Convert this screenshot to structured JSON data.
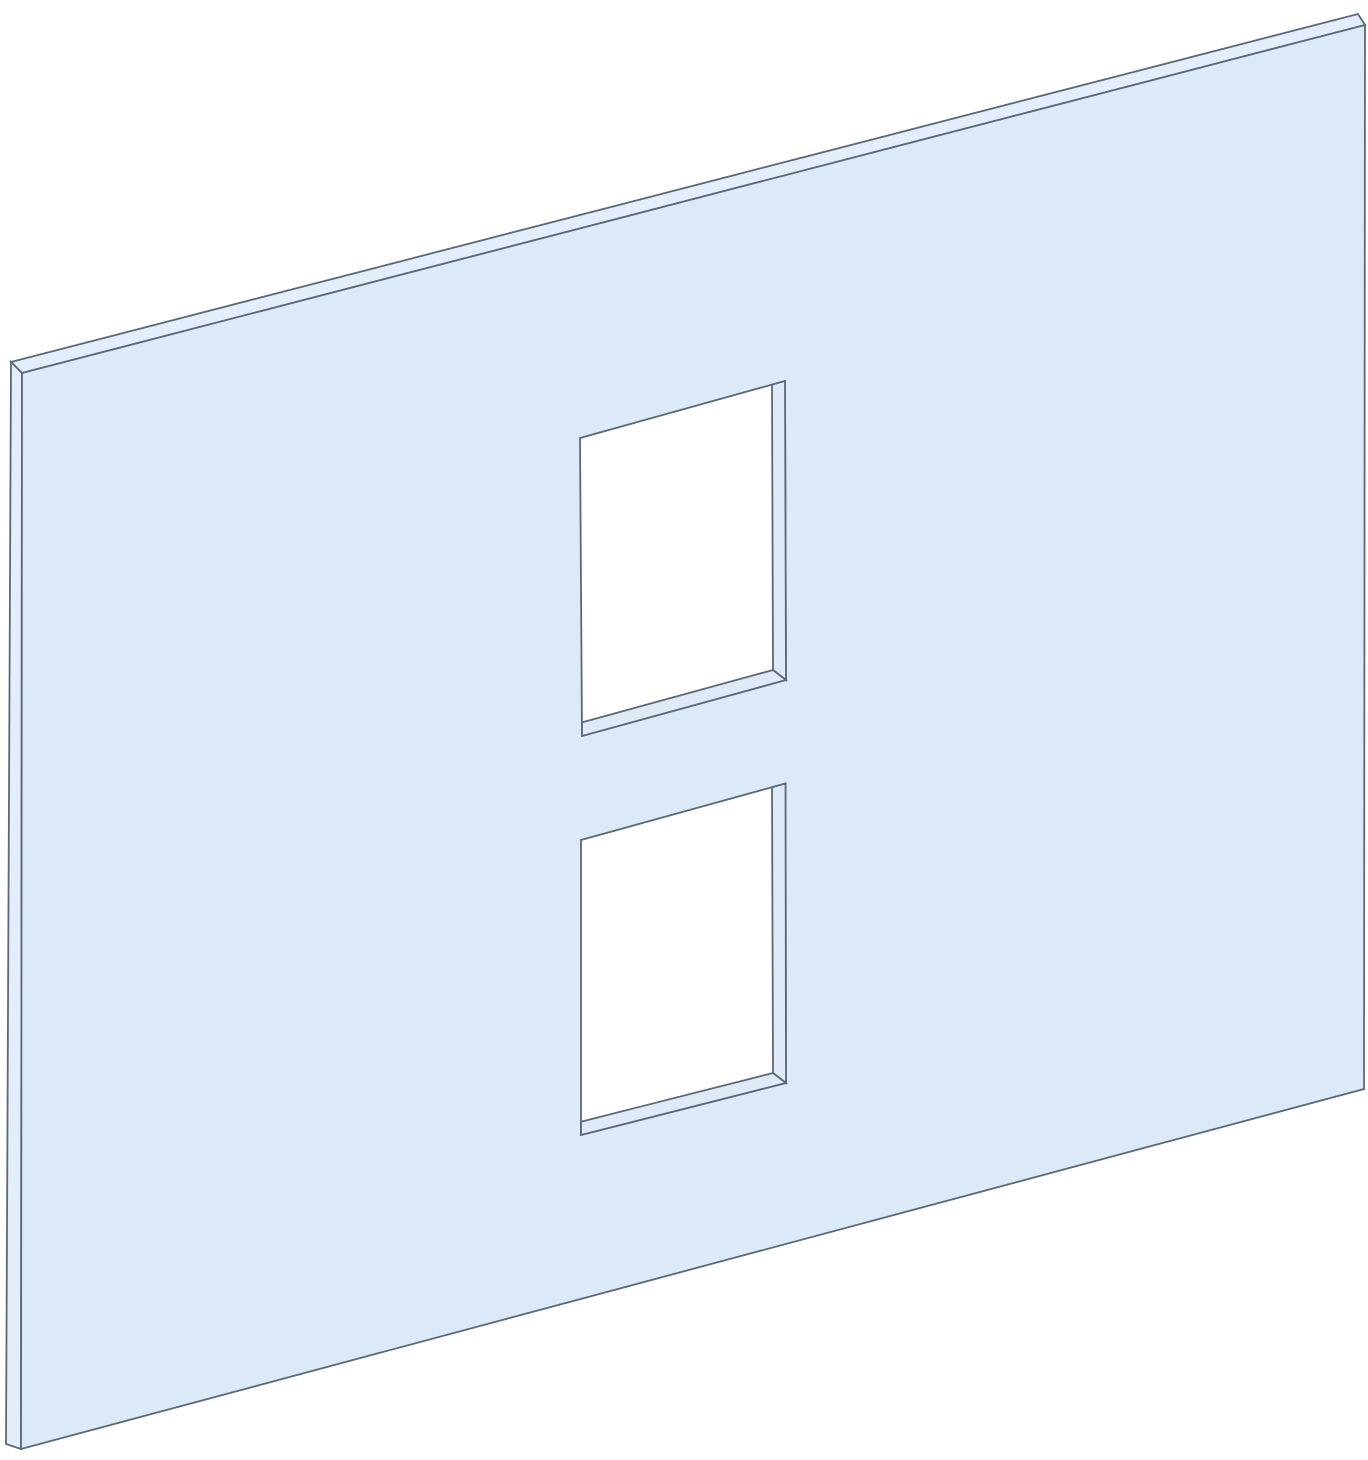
{
  "canvas": {
    "width": 1368,
    "height": 1460,
    "background": "#ffffff"
  },
  "palette": {
    "panel_face": "#dce9f7",
    "panel_edge_face": "#e4eefa",
    "inner_wall": "#dfeaf6",
    "hole": "#ffffff",
    "line": "#5a6978",
    "line_width": 1.8
  },
  "shapes": [
    {
      "name": "panel-top-edge-face",
      "type": "polygon",
      "fill": "panel_edge_face",
      "points": [
        [
          22,
          373
        ],
        [
          11,
          362
        ],
        [
          1358,
          14
        ],
        [
          1365,
          25
        ]
      ]
    },
    {
      "name": "panel-left-edge-face",
      "type": "polygon",
      "fill": "panel_edge_face",
      "points": [
        [
          11,
          362
        ],
        [
          22,
          373
        ],
        [
          21,
          1449
        ],
        [
          6,
          1444
        ]
      ]
    },
    {
      "name": "panel-front-face",
      "type": "path",
      "fill": "panel_face",
      "fillRule": "evenodd",
      "d": "M22,373 L1365,25 L1364,1089 L21,1449 Z M580,438 L785,381 L786,680 L582,736 Z M581,840 L785.5,783.5 L786,1083 L581,1135 Z"
    },
    {
      "name": "upper-cutout-right-inner-wall",
      "type": "polygon",
      "fill": "inner_wall",
      "points": [
        [
          772,
          384.6
        ],
        [
          785,
          381
        ],
        [
          786,
          680
        ],
        [
          773,
          670
        ]
      ]
    },
    {
      "name": "upper-cutout-bottom-inner-wall",
      "type": "polygon",
      "fill": "inner_wall",
      "points": [
        [
          582,
          722.4
        ],
        [
          773,
          670
        ],
        [
          786,
          680
        ],
        [
          582,
          736
        ]
      ]
    },
    {
      "name": "lower-cutout-right-inner-wall",
      "type": "polygon",
      "fill": "inner_wall",
      "points": [
        [
          772,
          787.3
        ],
        [
          785.5,
          783.5
        ],
        [
          786,
          1083
        ],
        [
          773,
          1073
        ]
      ]
    },
    {
      "name": "lower-cutout-bottom-inner-wall",
      "type": "polygon",
      "fill": "inner_wall",
      "points": [
        [
          581,
          1121.7
        ],
        [
          773,
          1073
        ],
        [
          786,
          1083
        ],
        [
          581,
          1135
        ]
      ]
    }
  ]
}
